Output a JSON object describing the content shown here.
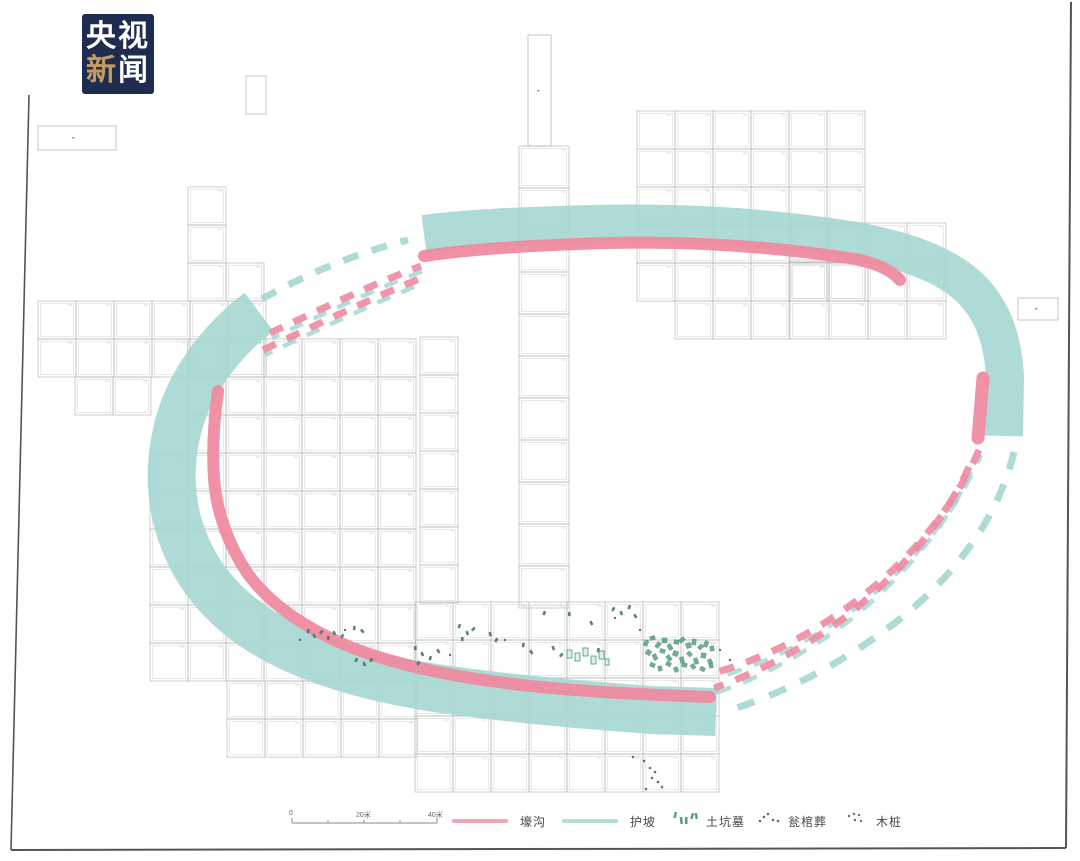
{
  "logo": {
    "line1": "央视",
    "char_xin": "新",
    "char_wen": "闻",
    "bg": "#1e2c4f",
    "accent": "#c59a62"
  },
  "legend": {
    "scale": {
      "labels": [
        "0",
        "20米",
        "40米"
      ]
    },
    "items": [
      {
        "label": "壕沟",
        "type": "line",
        "color": "#f1a6b4"
      },
      {
        "label": "护坡",
        "type": "line",
        "color": "#b2dcd6"
      },
      {
        "label": "土坑墓",
        "type": "tomb-marks"
      },
      {
        "label": "瓮棺葬",
        "type": "urn-marks"
      },
      {
        "label": "木桩",
        "type": "stake-marks"
      }
    ]
  },
  "map": {
    "colors": {
      "teal": "#a6d7d1",
      "pink": "#f08ba1",
      "grid": "#b7b7b7",
      "gridInner": "#d2d2d2",
      "tick": "#c6c6c6",
      "tombGreen": "#55a08c",
      "tombDark": "#46776a",
      "dot": "#6b6b6b",
      "frame": "#555555"
    },
    "blocks": [
      [
        519,
        146,
        1,
        11,
        50,
        42
      ],
      [
        637,
        111,
        6,
        5,
        38,
        38
      ],
      [
        675,
        301,
        3,
        1,
        38,
        38
      ],
      [
        790,
        223,
        4,
        2,
        39,
        39
      ],
      [
        790,
        301,
        4,
        1,
        39,
        38
      ],
      [
        188,
        187,
        1,
        2,
        38,
        38
      ],
      [
        188,
        263,
        2,
        1,
        38,
        38
      ],
      [
        38,
        301,
        2,
        2,
        38,
        38
      ],
      [
        114,
        301,
        4,
        2,
        38,
        38
      ],
      [
        75,
        377,
        2,
        1,
        38,
        38
      ],
      [
        188,
        339,
        6,
        9,
        38,
        38
      ],
      [
        150,
        453,
        1,
        6,
        38,
        38
      ],
      [
        420,
        337,
        1,
        7,
        38,
        38
      ],
      [
        415,
        602,
        8,
        5,
        38,
        38
      ],
      [
        227,
        681,
        5,
        2,
        38,
        38
      ]
    ],
    "rects": [
      [
        528,
        35,
        23,
        111
      ],
      [
        246,
        76,
        20,
        38
      ],
      [
        38,
        126,
        78,
        24
      ],
      [
        1018,
        298,
        40,
        22
      ]
    ],
    "frame": [
      {
        "d": "M 29 95 L 11 850",
        "w": 1.6
      },
      {
        "d": "M 11 850 L 1066 848",
        "w": 2
      },
      {
        "d": "M 1071 2 L 1066 848",
        "w": 2
      }
    ],
    "bands": [
      {
        "d": "M 424 234 C 470 228 520 226 590 224 C 680 222 760 226 850 240 C 905 250 945 264 970 288 C 995 312 1004 345 1005 380 L 1004 436",
        "c": "teal",
        "w": 38,
        "cap": "butt"
      },
      {
        "d": "M 259 312 C 235 330 215 352 199 378 C 184 402 174 432 172 465 C 170 500 178 535 196 566 C 216 600 247 626 286 645 C 332 667 382 680 442 689 C 512 699 582 705 652 710 L 716 712",
        "c": "teal",
        "w": 48,
        "cap": "butt"
      },
      {
        "d": "M 424 256 C 480 248 540 245 610 243 C 690 241 770 246 855 259 C 880 264 893 272 900 280",
        "c": "pink",
        "w": 12,
        "cap": "round"
      },
      {
        "d": "M 983 378 C 981 400 980 418 978 438",
        "c": "pink",
        "w": 13,
        "cap": "round"
      },
      {
        "d": "M 218 391 C 214 420 212 450 214 478 C 216 510 228 545 248 574 C 270 604 305 628 348 646 C 400 667 460 678 530 686 C 590 692 650 695 710 697",
        "c": "pink",
        "w": 12,
        "cap": "round"
      }
    ],
    "dashes": [
      {
        "d": "M 262 299 C 310 272 360 252 408 240",
        "c": "teal",
        "w": 7,
        "da": "16 14"
      },
      {
        "d": "M 270 333 C 320 310 370 285 421 266",
        "c": "pink",
        "w": 7,
        "da": "14 12"
      },
      {
        "d": "M 263 350 C 320 323 375 297 419 279",
        "c": "pink",
        "w": 7,
        "da": "14 12"
      },
      {
        "d": "M 1014 452 C 1000 510 965 565 905 615 C 855 655 795 690 724 712",
        "c": "teal",
        "w": 7,
        "da": "18 16"
      },
      {
        "d": "M 979 450 C 955 505 915 555 860 598 C 815 633 765 658 717 672",
        "c": "pink",
        "w": 7,
        "da": "15 13"
      },
      {
        "d": "M 969 467 C 945 520 905 567 852 612 C 808 646 760 672 714 688",
        "c": "pink",
        "w": 7,
        "da": "15 13"
      }
    ],
    "tombCluster": [
      [
        644,
        640,
        4,
        6,
        20
      ],
      [
        650,
        636,
        5,
        4,
        -15
      ],
      [
        656,
        642,
        4,
        6,
        40
      ],
      [
        662,
        638,
        5,
        5,
        0
      ],
      [
        668,
        644,
        4,
        6,
        -30
      ],
      [
        674,
        640,
        5,
        4,
        15
      ],
      [
        680,
        637,
        4,
        6,
        50
      ],
      [
        686,
        643,
        5,
        5,
        -20
      ],
      [
        692,
        639,
        4,
        6,
        10
      ],
      [
        698,
        645,
        5,
        4,
        -40
      ],
      [
        704,
        641,
        4,
        6,
        25
      ],
      [
        710,
        646,
        4,
        5,
        -10
      ],
      [
        646,
        650,
        5,
        5,
        35
      ],
      [
        653,
        654,
        4,
        6,
        -25
      ],
      [
        660,
        649,
        5,
        4,
        15
      ],
      [
        667,
        655,
        4,
        6,
        -35
      ],
      [
        673,
        651,
        5,
        5,
        20
      ],
      [
        680,
        657,
        4,
        6,
        -15
      ],
      [
        687,
        652,
        5,
        4,
        45
      ],
      [
        694,
        658,
        4,
        6,
        -20
      ],
      [
        701,
        653,
        5,
        5,
        10
      ],
      [
        708,
        659,
        4,
        5,
        -30
      ],
      [
        650,
        663,
        5,
        4,
        20
      ],
      [
        658,
        666,
        4,
        5,
        -15
      ],
      [
        666,
        662,
        5,
        4,
        30
      ],
      [
        674,
        667,
        4,
        5,
        -25
      ],
      [
        682,
        663,
        5,
        4,
        15
      ],
      [
        691,
        664,
        4,
        5,
        -35
      ],
      [
        700,
        667,
        5,
        4,
        25
      ],
      [
        709,
        663,
        4,
        5,
        -15
      ]
    ],
    "tombRects": [
      [
        567,
        650,
        5,
        8
      ],
      [
        575,
        653,
        5,
        8
      ],
      [
        583,
        648,
        5,
        8
      ],
      [
        591,
        656,
        5,
        8
      ],
      [
        599,
        651,
        5,
        8
      ],
      [
        605,
        659,
        4,
        6
      ]
    ],
    "marks": [
      [
        307,
        629,
        20
      ],
      [
        313,
        634,
        -30
      ],
      [
        320,
        630,
        45
      ],
      [
        327,
        636,
        0
      ],
      [
        333,
        631,
        -20
      ],
      [
        341,
        634,
        30
      ],
      [
        353,
        626,
        10
      ],
      [
        361,
        629,
        -40
      ],
      [
        355,
        658,
        25
      ],
      [
        363,
        662,
        -15
      ],
      [
        370,
        658,
        40
      ],
      [
        414,
        646,
        0
      ],
      [
        421,
        652,
        -25
      ],
      [
        417,
        661,
        35
      ],
      [
        429,
        656,
        15
      ],
      [
        437,
        649,
        -30
      ],
      [
        458,
        624,
        20
      ],
      [
        466,
        631,
        -20
      ],
      [
        472,
        627,
        45
      ],
      [
        461,
        637,
        0
      ],
      [
        489,
        632,
        -15
      ],
      [
        495,
        638,
        30
      ],
      [
        522,
        643,
        10
      ],
      [
        530,
        650,
        -35
      ],
      [
        543,
        611,
        20
      ],
      [
        552,
        646,
        -20
      ],
      [
        560,
        653,
        40
      ],
      [
        568,
        612,
        0
      ],
      [
        590,
        621,
        -25
      ],
      [
        597,
        648,
        15
      ],
      [
        612,
        607,
        30
      ],
      [
        620,
        611,
        -15
      ],
      [
        628,
        605,
        20
      ],
      [
        634,
        614,
        -30
      ]
    ],
    "urnDots": [
      [
        300,
        640
      ],
      [
        345,
        630
      ],
      [
        450,
        655
      ],
      [
        505,
        640
      ],
      [
        615,
        618
      ],
      [
        640,
        630
      ],
      [
        720,
        650
      ],
      [
        730,
        660
      ]
    ],
    "stakeDots": [
      [
        633,
        757
      ],
      [
        644,
        761
      ],
      [
        650,
        768
      ],
      [
        655,
        772
      ],
      [
        652,
        778
      ],
      [
        658,
        782
      ],
      [
        662,
        787
      ],
      [
        646,
        789
      ]
    ],
    "specks": [
      [
        72,
        137
      ],
      [
        537,
        90
      ],
      [
        1035,
        308
      ]
    ]
  }
}
